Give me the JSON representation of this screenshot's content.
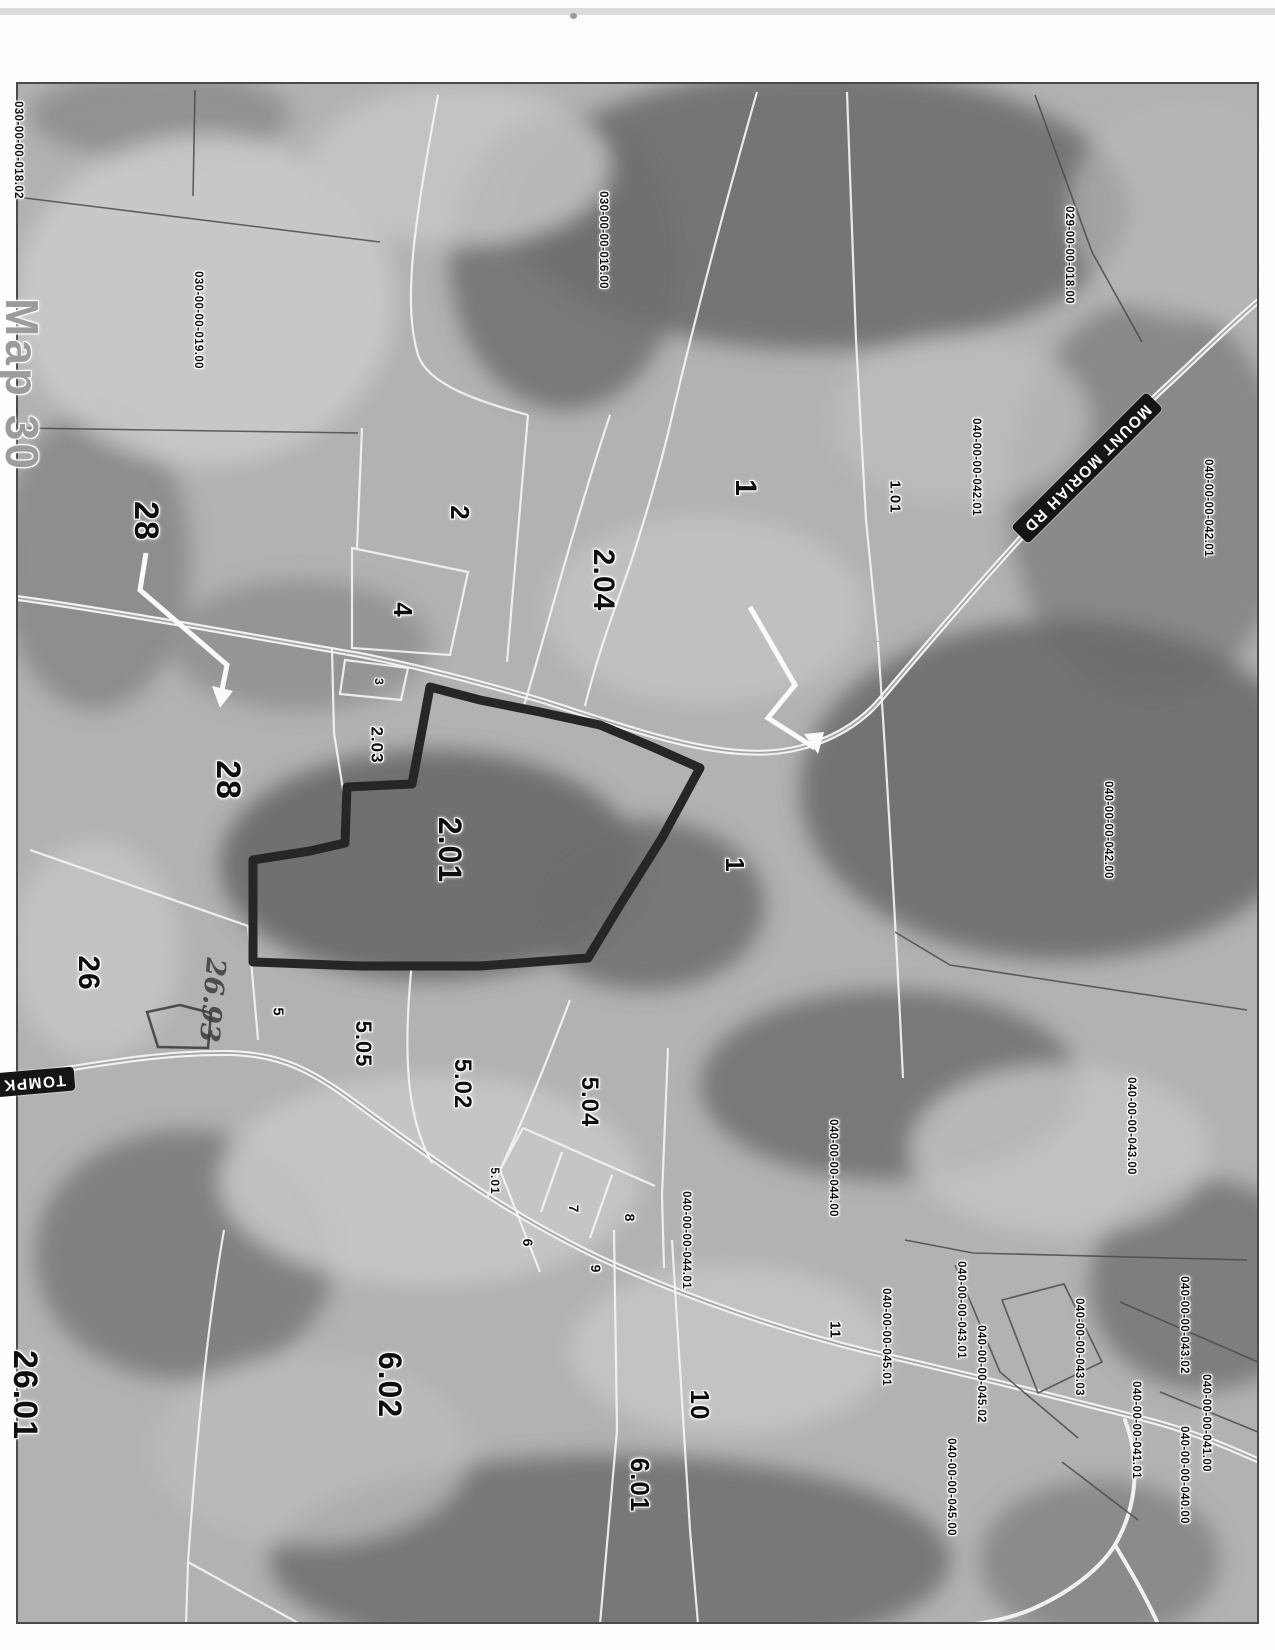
{
  "document": {
    "margin_title": "Map 30"
  },
  "map": {
    "highlighted_parcel": "2.01",
    "handwritten_note": "26.93",
    "roads": [
      {
        "name": "MOUNT MORIAH RD"
      },
      {
        "name": "TOMPK"
      }
    ],
    "parcel_ids": [
      {
        "text": "030-00-00-018.02",
        "x": 17,
        "y": 150
      },
      {
        "text": "030-00-00-019.00",
        "x": 197,
        "y": 320
      },
      {
        "text": "030-00-00-016.00",
        "x": 602,
        "y": 240
      },
      {
        "text": "029-00-00-018.00",
        "x": 1068,
        "y": 255
      },
      {
        "text": "040-00-00-042.01",
        "x": 975,
        "y": 467
      },
      {
        "text": "040-00-00-042.01",
        "x": 1207,
        "y": 508
      },
      {
        "text": "040-00-00-042.00",
        "x": 1107,
        "y": 830
      },
      {
        "text": "040-00-00-043.00",
        "x": 1130,
        "y": 1126
      },
      {
        "text": "040-00-00-044.00",
        "x": 832,
        "y": 1168
      },
      {
        "text": "040-00-00-044.01",
        "x": 685,
        "y": 1240
      },
      {
        "text": "040-00-00-043.01",
        "x": 960,
        "y": 1310
      },
      {
        "text": "040-00-00-045.01",
        "x": 885,
        "y": 1337
      },
      {
        "text": "040-00-00-043.03",
        "x": 1078,
        "y": 1347
      },
      {
        "text": "040-00-00-043.02",
        "x": 1183,
        "y": 1325
      },
      {
        "text": "040-00-00-045.02",
        "x": 980,
        "y": 1374
      },
      {
        "text": "040-00-00-041.01",
        "x": 1135,
        "y": 1430
      },
      {
        "text": "040-00-00-041.00",
        "x": 1205,
        "y": 1423
      },
      {
        "text": "040-00-00-040.00",
        "x": 1183,
        "y": 1475
      },
      {
        "text": "040-00-00-045.00",
        "x": 950,
        "y": 1487
      }
    ],
    "parcel_numbers": [
      {
        "text": "28",
        "x": 146,
        "y": 521,
        "size": 34
      },
      {
        "text": "28",
        "x": 228,
        "y": 780,
        "size": 34
      },
      {
        "text": "26",
        "x": 88,
        "y": 973,
        "size": 30
      },
      {
        "text": "26.01",
        "x": 25,
        "y": 1395,
        "size": 34
      },
      {
        "text": "2",
        "x": 460,
        "y": 513,
        "size": 26
      },
      {
        "text": "4",
        "x": 403,
        "y": 610,
        "size": 26
      },
      {
        "text": "3",
        "x": 379,
        "y": 682,
        "size": 12
      },
      {
        "text": "2.03",
        "x": 377,
        "y": 745,
        "size": 17
      },
      {
        "text": "2.04",
        "x": 603,
        "y": 580,
        "size": 30
      },
      {
        "text": "2.01",
        "x": 450,
        "y": 850,
        "size": 32
      },
      {
        "text": "1",
        "x": 745,
        "y": 488,
        "size": 30
      },
      {
        "text": "1.01",
        "x": 895,
        "y": 497,
        "size": 15
      },
      {
        "text": "1",
        "x": 735,
        "y": 865,
        "size": 26
      },
      {
        "text": "5",
        "x": 278,
        "y": 1012,
        "size": 15
      },
      {
        "text": "5.05",
        "x": 363,
        "y": 1044,
        "size": 22
      },
      {
        "text": "5.02",
        "x": 462,
        "y": 1084,
        "size": 24
      },
      {
        "text": "5.04",
        "x": 589,
        "y": 1102,
        "size": 24
      },
      {
        "text": "5.01",
        "x": 495,
        "y": 1181,
        "size": 12
      },
      {
        "text": "7",
        "x": 574,
        "y": 1209,
        "size": 14
      },
      {
        "text": "8",
        "x": 630,
        "y": 1218,
        "size": 14
      },
      {
        "text": "6",
        "x": 528,
        "y": 1243,
        "size": 14
      },
      {
        "text": "9",
        "x": 596,
        "y": 1269,
        "size": 14
      },
      {
        "text": "6.02",
        "x": 390,
        "y": 1385,
        "size": 32
      },
      {
        "text": "6.01",
        "x": 640,
        "y": 1485,
        "size": 26
      },
      {
        "text": "10",
        "x": 700,
        "y": 1405,
        "size": 26
      },
      {
        "text": "11",
        "x": 835,
        "y": 1330,
        "size": 15
      }
    ]
  },
  "colors": {
    "photo_base": "#b2b2b2",
    "forest": "#6e6e6e",
    "field": "#c9c9c9",
    "boundary_white": "#f4f4f4",
    "boundary_dark": "#4a4a4a",
    "highlight_outline": "#262626",
    "road_badge_bg": "#151515",
    "road_badge_text": "#ffffff"
  }
}
